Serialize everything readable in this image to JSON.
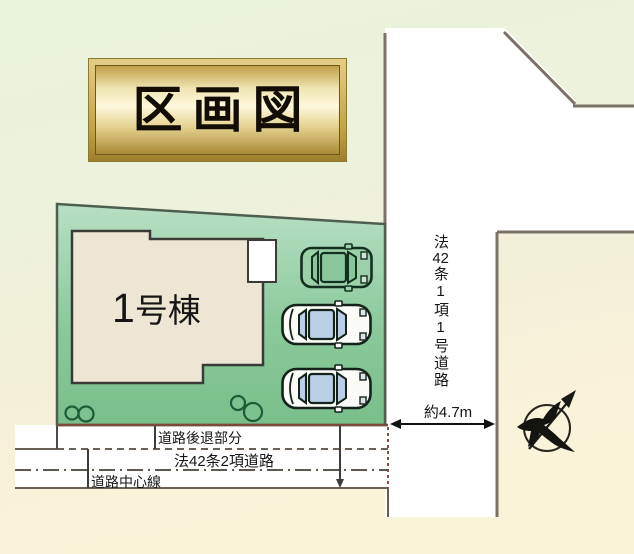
{
  "title": {
    "text": "区画図"
  },
  "building": {
    "number": "1",
    "suffix": "号棟"
  },
  "vertical_road": {
    "label_prefix": "法",
    "label_number": "42",
    "label_suffix": "条1項1号道路",
    "width_label": "約4.7m"
  },
  "bottom_road": {
    "setback_label": "道路後退部分",
    "name_label": "法42条2項道路",
    "centerline_label": "道路中心線"
  },
  "icons": {
    "compass": "north-arrow-bird",
    "cars": [
      "suv-top-view-green",
      "sedan-top-view-white",
      "sedan-top-view-white"
    ],
    "bushes": "round-shrubs"
  },
  "colors": {
    "plot_green": "#84c694",
    "plot_green_light": "#b8dfc4",
    "building_fill": "#ede6d3",
    "porch_fill": "#ffffff",
    "road_fill": "#ffffff",
    "road_line": "#7b7266",
    "setback_line": "#7a4a3c",
    "dash_line": "#6b6157",
    "gold_light": "#fdf7d9",
    "gold_dark": "#aa8a36",
    "bg_top": "#eaf3de",
    "bg_bottom": "#f9f3d7",
    "car_glass": "#b9cfe6",
    "bush_green": "#7cc28e",
    "ink": "#161616"
  }
}
